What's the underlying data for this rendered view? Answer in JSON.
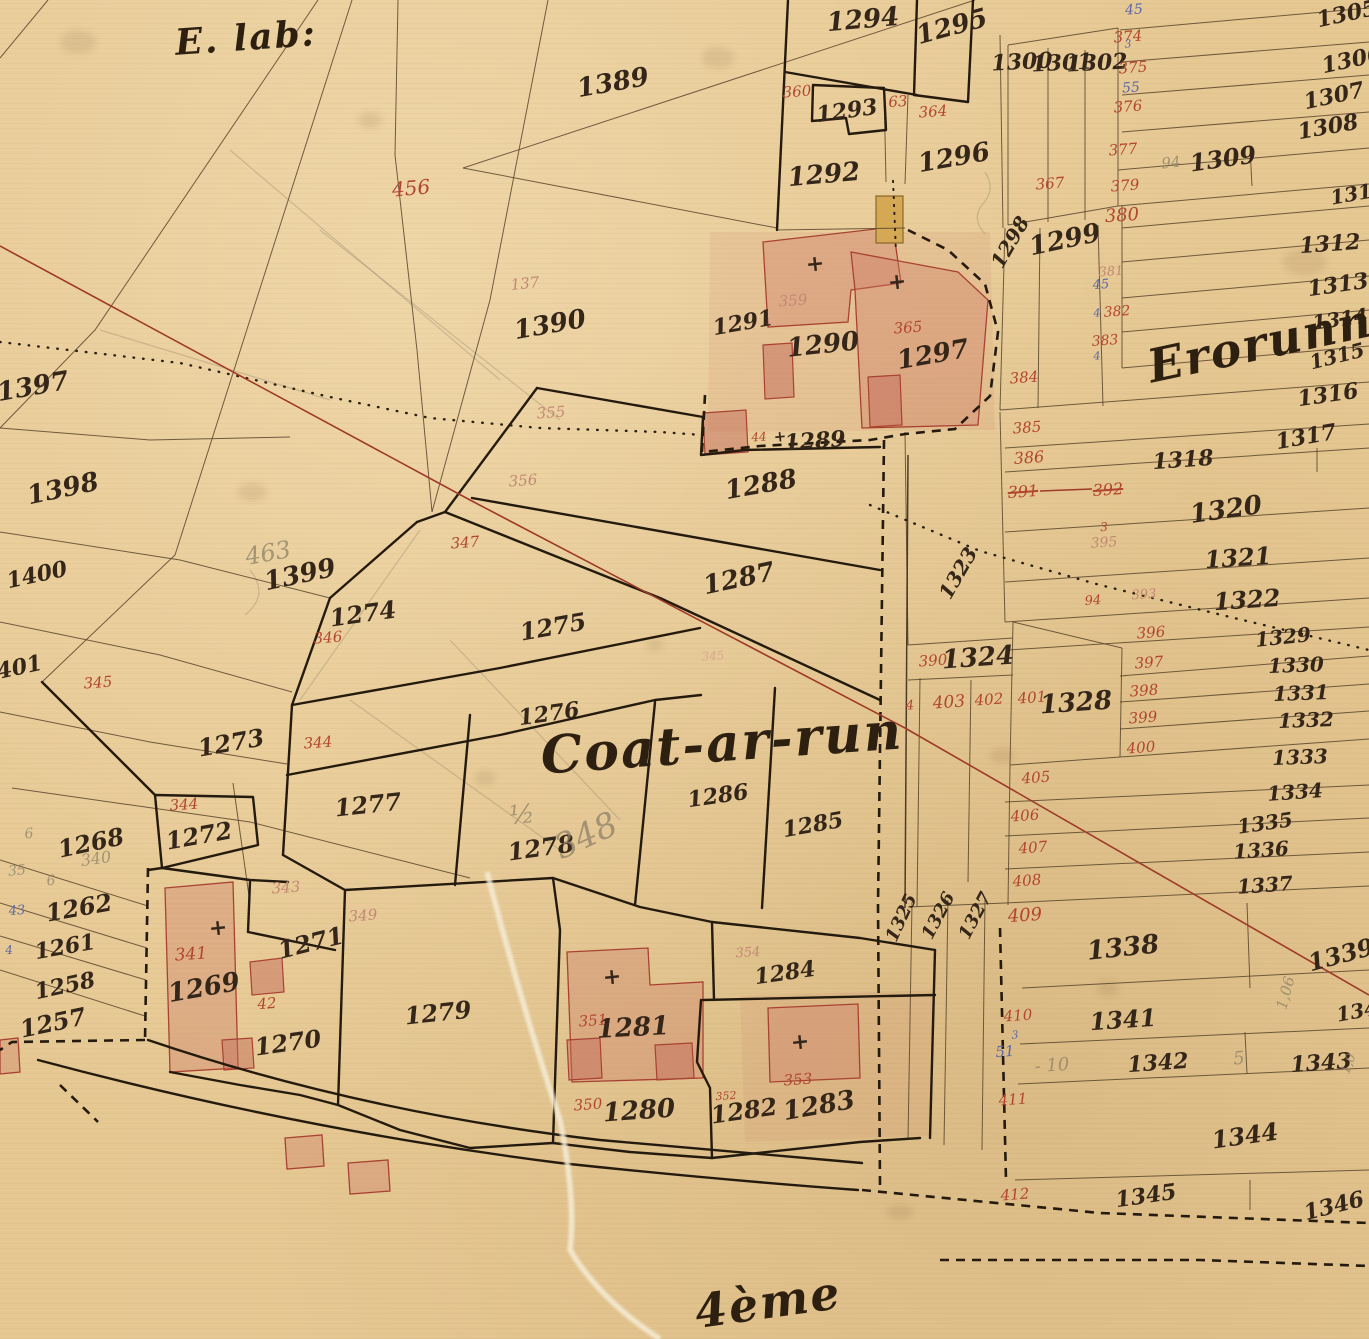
{
  "map_title": "Coat-ar-run",
  "corner_note": "E. lab:",
  "district_note": "Erorunnie",
  "bottom_note": "4ème",
  "colors": {
    "paper": "#e6c893",
    "ink": "#35261a",
    "red": "#b2452f",
    "blue": "#5b68a8",
    "pencil": "#8d8168",
    "building": "#cd7d69",
    "survey_line": "#9e3a28"
  },
  "labels": [
    {
      "t": "1294",
      "x": 863,
      "y": 20,
      "s": 26,
      "c": "ink",
      "r": -5
    },
    {
      "t": "1295",
      "x": 952,
      "y": 27,
      "s": 26,
      "c": "ink",
      "r": -15
    },
    {
      "t": "1300",
      "x": 1022,
      "y": 62,
      "s": 22,
      "c": "ink",
      "r": -3
    },
    {
      "t": "1301",
      "x": 1062,
      "y": 63,
      "s": 22,
      "c": "ink",
      "r": -3
    },
    {
      "t": "1302",
      "x": 1097,
      "y": 63,
      "s": 22,
      "c": "ink",
      "r": -3
    },
    {
      "t": "1293",
      "x": 847,
      "y": 111,
      "s": 22,
      "c": "ink",
      "r": -8
    },
    {
      "t": "1292",
      "x": 824,
      "y": 175,
      "s": 26,
      "c": "ink",
      "r": -5
    },
    {
      "t": "1296",
      "x": 954,
      "y": 158,
      "s": 26,
      "c": "ink",
      "r": -10
    },
    {
      "t": "1305",
      "x": 1347,
      "y": 14,
      "s": 22,
      "c": "ink",
      "r": -12
    },
    {
      "t": "1306",
      "x": 1352,
      "y": 60,
      "s": 22,
      "c": "ink",
      "r": -12
    },
    {
      "t": "1307",
      "x": 1334,
      "y": 96,
      "s": 22,
      "c": "ink",
      "r": -12
    },
    {
      "t": "1308",
      "x": 1328,
      "y": 127,
      "s": 22,
      "c": "ink",
      "r": -10
    },
    {
      "t": "1309",
      "x": 1223,
      "y": 159,
      "s": 24,
      "c": "ink",
      "r": -8
    },
    {
      "t": "1311",
      "x": 1358,
      "y": 193,
      "s": 20,
      "c": "ink",
      "r": -10
    },
    {
      "t": "1312",
      "x": 1330,
      "y": 244,
      "s": 22,
      "c": "ink",
      "r": -4
    },
    {
      "t": "1313",
      "x": 1338,
      "y": 285,
      "s": 22,
      "c": "ink",
      "r": -8
    },
    {
      "t": "1314",
      "x": 1340,
      "y": 319,
      "s": 20,
      "c": "ink",
      "r": -8
    },
    {
      "t": "1315",
      "x": 1337,
      "y": 356,
      "s": 20,
      "c": "ink",
      "r": -14
    },
    {
      "t": "1298",
      "x": 1010,
      "y": 242,
      "s": 20,
      "c": "ink",
      "r": -60
    },
    {
      "t": "1299",
      "x": 1065,
      "y": 240,
      "s": 26,
      "c": "ink",
      "r": -12
    },
    {
      "t": "1291",
      "x": 743,
      "y": 323,
      "s": 22,
      "c": "ink",
      "r": -10
    },
    {
      "t": "1290",
      "x": 823,
      "y": 345,
      "s": 26,
      "c": "ink",
      "r": -6
    },
    {
      "t": "1297",
      "x": 933,
      "y": 355,
      "s": 26,
      "c": "ink",
      "r": -10
    },
    {
      "t": "+",
      "x": 780,
      "y": 437,
      "s": 15,
      "c": "ink",
      "r": 0
    },
    {
      "t": "1289",
      "x": 815,
      "y": 441,
      "s": 22,
      "c": "ink",
      "r": -4
    },
    {
      "t": "1288",
      "x": 761,
      "y": 485,
      "s": 26,
      "c": "ink",
      "r": -10
    },
    {
      "t": "1287",
      "x": 739,
      "y": 579,
      "s": 26,
      "c": "ink",
      "r": -12
    },
    {
      "t": "1316",
      "x": 1328,
      "y": 395,
      "s": 22,
      "c": "ink",
      "r": -8
    },
    {
      "t": "1317",
      "x": 1306,
      "y": 437,
      "s": 22,
      "c": "ink",
      "r": -10
    },
    {
      "t": "1318",
      "x": 1183,
      "y": 460,
      "s": 22,
      "c": "ink",
      "r": -4
    },
    {
      "t": "1320",
      "x": 1226,
      "y": 510,
      "s": 26,
      "c": "ink",
      "r": -8
    },
    {
      "t": "1321",
      "x": 1238,
      "y": 558,
      "s": 24,
      "c": "ink",
      "r": -4
    },
    {
      "t": "1322",
      "x": 1247,
      "y": 600,
      "s": 24,
      "c": "ink",
      "r": -4
    },
    {
      "t": "1389",
      "x": 613,
      "y": 83,
      "s": 26,
      "c": "ink",
      "r": -10
    },
    {
      "t": "1390",
      "x": 550,
      "y": 325,
      "s": 26,
      "c": "ink",
      "r": -10
    },
    {
      "t": "1397",
      "x": 33,
      "y": 387,
      "s": 26,
      "c": "ink",
      "r": -10
    },
    {
      "t": "1398",
      "x": 63,
      "y": 489,
      "s": 26,
      "c": "ink",
      "r": -12
    },
    {
      "t": "1400",
      "x": 37,
      "y": 575,
      "s": 22,
      "c": "ink",
      "r": -12
    },
    {
      "t": "1401",
      "x": 12,
      "y": 669,
      "s": 22,
      "c": "ink",
      "r": -12
    },
    {
      "t": "1399",
      "x": 300,
      "y": 575,
      "s": 26,
      "c": "ink",
      "r": -12
    },
    {
      "t": "1274",
      "x": 363,
      "y": 614,
      "s": 24,
      "c": "ink",
      "r": -8
    },
    {
      "t": "1273",
      "x": 231,
      "y": 743,
      "s": 24,
      "c": "ink",
      "r": -10
    },
    {
      "t": "1272",
      "x": 199,
      "y": 836,
      "s": 24,
      "c": "ink",
      "r": -10
    },
    {
      "t": "1275",
      "x": 553,
      "y": 627,
      "s": 24,
      "c": "ink",
      "r": -10
    },
    {
      "t": "1276",
      "x": 549,
      "y": 714,
      "s": 22,
      "c": "ink",
      "r": -8
    },
    {
      "t": "1277",
      "x": 368,
      "y": 805,
      "s": 24,
      "c": "ink",
      "r": -6
    },
    {
      "t": "1278",
      "x": 541,
      "y": 848,
      "s": 24,
      "c": "ink",
      "r": -8
    },
    {
      "t": "1286",
      "x": 718,
      "y": 796,
      "s": 22,
      "c": "ink",
      "r": -8
    },
    {
      "t": "1285",
      "x": 813,
      "y": 825,
      "s": 22,
      "c": "ink",
      "r": -10
    },
    {
      "t": "1268",
      "x": 91,
      "y": 843,
      "s": 24,
      "c": "ink",
      "r": -12
    },
    {
      "t": "1262",
      "x": 79,
      "y": 908,
      "s": 24,
      "c": "ink",
      "r": -10
    },
    {
      "t": "1261",
      "x": 65,
      "y": 947,
      "s": 22,
      "c": "ink",
      "r": -10
    },
    {
      "t": "1258",
      "x": 65,
      "y": 986,
      "s": 22,
      "c": "ink",
      "r": -12
    },
    {
      "t": "1257",
      "x": 53,
      "y": 1023,
      "s": 24,
      "c": "ink",
      "r": -12
    },
    {
      "t": "1269",
      "x": 204,
      "y": 988,
      "s": 26,
      "c": "ink",
      "r": -10
    },
    {
      "t": "1270",
      "x": 288,
      "y": 1043,
      "s": 24,
      "c": "ink",
      "r": -8
    },
    {
      "t": "1271",
      "x": 311,
      "y": 943,
      "s": 24,
      "c": "ink",
      "r": -14
    },
    {
      "t": "1279",
      "x": 438,
      "y": 1013,
      "s": 24,
      "c": "ink",
      "r": -6
    },
    {
      "t": "1281",
      "x": 633,
      "y": 1028,
      "s": 26,
      "c": "ink",
      "r": -3
    },
    {
      "t": "1280",
      "x": 639,
      "y": 1111,
      "s": 26,
      "c": "ink",
      "r": -4
    },
    {
      "t": "1282",
      "x": 744,
      "y": 1111,
      "s": 24,
      "c": "ink",
      "r": -8
    },
    {
      "t": "1283",
      "x": 819,
      "y": 1106,
      "s": 26,
      "c": "ink",
      "r": -10
    },
    {
      "t": "1284",
      "x": 785,
      "y": 973,
      "s": 22,
      "c": "ink",
      "r": -8
    },
    {
      "t": "1323",
      "x": 958,
      "y": 573,
      "s": 20,
      "c": "ink",
      "r": -60
    },
    {
      "t": "1324",
      "x": 978,
      "y": 658,
      "s": 26,
      "c": "ink",
      "r": -4
    },
    {
      "t": "1328",
      "x": 1076,
      "y": 703,
      "s": 26,
      "c": "ink",
      "r": -4
    },
    {
      "t": "1329",
      "x": 1283,
      "y": 637,
      "s": 20,
      "c": "ink",
      "r": -6
    },
    {
      "t": "1330",
      "x": 1296,
      "y": 665,
      "s": 20,
      "c": "ink",
      "r": -2
    },
    {
      "t": "1331",
      "x": 1301,
      "y": 693,
      "s": 20,
      "c": "ink",
      "r": -2
    },
    {
      "t": "1332",
      "x": 1306,
      "y": 720,
      "s": 20,
      "c": "ink",
      "r": -2
    },
    {
      "t": "1333",
      "x": 1300,
      "y": 757,
      "s": 20,
      "c": "ink",
      "r": -2
    },
    {
      "t": "1334",
      "x": 1295,
      "y": 792,
      "s": 20,
      "c": "ink",
      "r": -4
    },
    {
      "t": "1335",
      "x": 1265,
      "y": 823,
      "s": 20,
      "c": "ink",
      "r": -8
    },
    {
      "t": "1336",
      "x": 1261,
      "y": 850,
      "s": 20,
      "c": "ink",
      "r": -4
    },
    {
      "t": "1337",
      "x": 1265,
      "y": 885,
      "s": 20,
      "c": "ink",
      "r": -4
    },
    {
      "t": "1338",
      "x": 1123,
      "y": 948,
      "s": 26,
      "c": "ink",
      "r": -6
    },
    {
      "t": "1339",
      "x": 1341,
      "y": 955,
      "s": 24,
      "c": "ink",
      "r": -15
    },
    {
      "t": "1325",
      "x": 902,
      "y": 918,
      "s": 18,
      "c": "ink",
      "r": -65
    },
    {
      "t": "1326",
      "x": 939,
      "y": 916,
      "s": 18,
      "c": "ink",
      "r": -62
    },
    {
      "t": "1327",
      "x": 976,
      "y": 916,
      "s": 18,
      "c": "ink",
      "r": -62
    },
    {
      "t": "1341",
      "x": 1123,
      "y": 1020,
      "s": 24,
      "c": "ink",
      "r": -4
    },
    {
      "t": "1342",
      "x": 1158,
      "y": 1063,
      "s": 22,
      "c": "ink",
      "r": -4
    },
    {
      "t": "1343",
      "x": 1321,
      "y": 1063,
      "s": 22,
      "c": "ink",
      "r": -4
    },
    {
      "t": "1340",
      "x": 1364,
      "y": 1010,
      "s": 20,
      "c": "ink",
      "r": -10
    },
    {
      "t": "1344",
      "x": 1245,
      "y": 1136,
      "s": 24,
      "c": "ink",
      "r": -8
    },
    {
      "t": "1345",
      "x": 1146,
      "y": 1196,
      "s": 22,
      "c": "ink",
      "r": -8
    },
    {
      "t": "1346",
      "x": 1334,
      "y": 1206,
      "s": 22,
      "c": "ink",
      "r": -14
    },
    {
      "t": "+",
      "x": 815,
      "y": 264,
      "s": 22,
      "c": "ink",
      "r": 0
    },
    {
      "t": "+",
      "x": 897,
      "y": 282,
      "s": 22,
      "c": "ink",
      "r": 0
    },
    {
      "t": "+",
      "x": 218,
      "y": 928,
      "s": 22,
      "c": "ink",
      "r": 0
    },
    {
      "t": "+",
      "x": 612,
      "y": 977,
      "s": 22,
      "c": "ink",
      "r": 0
    },
    {
      "t": "+",
      "x": 800,
      "y": 1042,
      "s": 22,
      "c": "ink",
      "r": 0
    },
    {
      "t": "456",
      "x": 411,
      "y": 188,
      "s": 20,
      "c": "red",
      "r": -5
    },
    {
      "t": "360",
      "x": 797,
      "y": 92,
      "s": 15,
      "c": "red",
      "r": -4
    },
    {
      "t": "63",
      "x": 898,
      "y": 102,
      "s": 15,
      "c": "red",
      "r": -4
    },
    {
      "t": "364",
      "x": 933,
      "y": 112,
      "s": 15,
      "c": "red",
      "r": -4
    },
    {
      "t": "367",
      "x": 1050,
      "y": 184,
      "s": 15,
      "c": "red",
      "r": -4
    },
    {
      "t": "374",
      "x": 1128,
      "y": 37,
      "s": 15,
      "c": "red",
      "r": -4
    },
    {
      "t": "375",
      "x": 1133,
      "y": 68,
      "s": 15,
      "c": "red",
      "r": -4
    },
    {
      "t": "376",
      "x": 1128,
      "y": 107,
      "s": 15,
      "c": "red",
      "r": -4
    },
    {
      "t": "377",
      "x": 1123,
      "y": 150,
      "s": 15,
      "c": "red",
      "r": -4
    },
    {
      "t": "379",
      "x": 1125,
      "y": 186,
      "s": 15,
      "c": "red",
      "r": -4
    },
    {
      "t": "380",
      "x": 1122,
      "y": 216,
      "s": 18,
      "c": "red",
      "r": -4
    },
    {
      "t": "381",
      "x": 1111,
      "y": 272,
      "s": 13,
      "c": "fred",
      "r": -4
    },
    {
      "t": "382",
      "x": 1117,
      "y": 312,
      "s": 14,
      "c": "red",
      "r": -4
    },
    {
      "t": "383",
      "x": 1105,
      "y": 341,
      "s": 14,
      "c": "red",
      "r": -4
    },
    {
      "t": "384",
      "x": 1024,
      "y": 378,
      "s": 15,
      "c": "red",
      "r": -4
    },
    {
      "t": "385",
      "x": 1027,
      "y": 428,
      "s": 15,
      "c": "red",
      "r": -4
    },
    {
      "t": "386",
      "x": 1029,
      "y": 458,
      "s": 16,
      "c": "red",
      "r": -4
    },
    {
      "t": "391",
      "x": 1023,
      "y": 492,
      "s": 16,
      "c": "red",
      "r": -4,
      "st": 1
    },
    {
      "t": "392",
      "x": 1108,
      "y": 490,
      "s": 16,
      "c": "red",
      "r": -4,
      "st": 1
    },
    {
      "t": "3",
      "x": 1104,
      "y": 527,
      "s": 12,
      "c": "red",
      "r": -4
    },
    {
      "t": "395",
      "x": 1104,
      "y": 543,
      "s": 14,
      "c": "fred",
      "r": -4
    },
    {
      "t": "94",
      "x": 1093,
      "y": 601,
      "s": 13,
      "c": "red",
      "r": -4
    },
    {
      "t": "393",
      "x": 1144,
      "y": 595,
      "s": 13,
      "c": "fred",
      "r": -4
    },
    {
      "t": "396",
      "x": 1151,
      "y": 633,
      "s": 15,
      "c": "red",
      "r": -4
    },
    {
      "t": "397",
      "x": 1149,
      "y": 663,
      "s": 15,
      "c": "red",
      "r": -4
    },
    {
      "t": "398",
      "x": 1144,
      "y": 691,
      "s": 15,
      "c": "red",
      "r": -4
    },
    {
      "t": "399",
      "x": 1143,
      "y": 718,
      "s": 15,
      "c": "red",
      "r": -4
    },
    {
      "t": "400",
      "x": 1141,
      "y": 748,
      "s": 15,
      "c": "red",
      "r": -4
    },
    {
      "t": "390",
      "x": 933,
      "y": 661,
      "s": 15,
      "c": "red",
      "r": -4
    },
    {
      "t": "403",
      "x": 949,
      "y": 703,
      "s": 17,
      "c": "red",
      "r": -4
    },
    {
      "t": "402",
      "x": 989,
      "y": 700,
      "s": 15,
      "c": "red",
      "r": -4
    },
    {
      "t": "401",
      "x": 1032,
      "y": 698,
      "s": 15,
      "c": "red",
      "r": -4
    },
    {
      "t": "4",
      "x": 910,
      "y": 706,
      "s": 13,
      "c": "red",
      "r": -4
    },
    {
      "t": "405",
      "x": 1036,
      "y": 778,
      "s": 15,
      "c": "red",
      "r": -4
    },
    {
      "t": "406",
      "x": 1025,
      "y": 816,
      "s": 15,
      "c": "red",
      "r": -4
    },
    {
      "t": "407",
      "x": 1033,
      "y": 848,
      "s": 15,
      "c": "red",
      "r": -4
    },
    {
      "t": "408",
      "x": 1027,
      "y": 881,
      "s": 15,
      "c": "red",
      "r": -4
    },
    {
      "t": "409",
      "x": 1025,
      "y": 916,
      "s": 18,
      "c": "red",
      "r": -4
    },
    {
      "t": "410",
      "x": 1018,
      "y": 1016,
      "s": 15,
      "c": "red",
      "r": -4
    },
    {
      "t": "411",
      "x": 1013,
      "y": 1100,
      "s": 15,
      "c": "red",
      "r": -4
    },
    {
      "t": "412",
      "x": 1015,
      "y": 1195,
      "s": 15,
      "c": "red",
      "r": -4
    },
    {
      "t": "359",
      "x": 793,
      "y": 301,
      "s": 15,
      "c": "fred",
      "r": -4
    },
    {
      "t": "365",
      "x": 908,
      "y": 328,
      "s": 15,
      "c": "red",
      "r": -4
    },
    {
      "t": "44",
      "x": 759,
      "y": 437,
      "s": 12,
      "c": "red",
      "r": -4
    },
    {
      "t": "355",
      "x": 551,
      "y": 413,
      "s": 15,
      "c": "fred",
      "r": -4
    },
    {
      "t": "356",
      "x": 523,
      "y": 481,
      "s": 15,
      "c": "fred",
      "r": -4
    },
    {
      "t": "347",
      "x": 465,
      "y": 543,
      "s": 15,
      "c": "red",
      "r": -4
    },
    {
      "t": "346",
      "x": 328,
      "y": 638,
      "s": 15,
      "c": "red",
      "r": -4
    },
    {
      "t": "345",
      "x": 98,
      "y": 683,
      "s": 15,
      "c": "red",
      "r": -4
    },
    {
      "t": "344",
      "x": 318,
      "y": 743,
      "s": 15,
      "c": "red",
      "r": -4
    },
    {
      "t": "344",
      "x": 184,
      "y": 805,
      "s": 15,
      "c": "red",
      "r": -4
    },
    {
      "t": "343",
      "x": 286,
      "y": 888,
      "s": 15,
      "c": "fred",
      "r": -4
    },
    {
      "t": "349",
      "x": 363,
      "y": 916,
      "s": 15,
      "c": "fred",
      "r": -4
    },
    {
      "t": "341",
      "x": 191,
      "y": 955,
      "s": 17,
      "c": "red",
      "r": -4
    },
    {
      "t": "42",
      "x": 267,
      "y": 1004,
      "s": 15,
      "c": "red",
      "r": -4
    },
    {
      "t": "350",
      "x": 588,
      "y": 1105,
      "s": 15,
      "c": "red",
      "r": -4
    },
    {
      "t": "351",
      "x": 593,
      "y": 1021,
      "s": 15,
      "c": "red",
      "r": -4
    },
    {
      "t": "352",
      "x": 726,
      "y": 1096,
      "s": 11,
      "c": "red",
      "r": -4
    },
    {
      "t": "353",
      "x": 798,
      "y": 1080,
      "s": 15,
      "c": "red",
      "r": -4
    },
    {
      "t": "354",
      "x": 748,
      "y": 953,
      "s": 13,
      "c": "fred",
      "r": -4
    },
    {
      "t": "345",
      "x": 713,
      "y": 656,
      "s": 12,
      "c": "fpink",
      "r": -4
    },
    {
      "t": "45",
      "x": 1134,
      "y": 10,
      "s": 14,
      "c": "blue",
      "r": -4
    },
    {
      "t": "3",
      "x": 1128,
      "y": 44,
      "s": 11,
      "c": "blue",
      "r": -4
    },
    {
      "t": "55",
      "x": 1131,
      "y": 88,
      "s": 14,
      "c": "blue",
      "r": -4
    },
    {
      "t": "45",
      "x": 1101,
      "y": 285,
      "s": 13,
      "c": "blue",
      "r": -4
    },
    {
      "t": "4",
      "x": 1097,
      "y": 313,
      "s": 11,
      "c": "blue",
      "r": -4
    },
    {
      "t": "4",
      "x": 1097,
      "y": 356,
      "s": 11,
      "c": "blue",
      "r": -4
    },
    {
      "t": "43",
      "x": 17,
      "y": 911,
      "s": 13,
      "c": "blue",
      "r": -4
    },
    {
      "t": "4",
      "x": 9,
      "y": 950,
      "s": 12,
      "c": "blue",
      "r": -4
    },
    {
      "t": "3",
      "x": 1015,
      "y": 1035,
      "s": 11,
      "c": "blue",
      "r": -4
    },
    {
      "t": "51",
      "x": 1005,
      "y": 1052,
      "s": 15,
      "c": "blue",
      "r": -4
    },
    {
      "t": "463",
      "x": 268,
      "y": 553,
      "s": 24,
      "c": "pencil",
      "r": -10
    },
    {
      "t": "340",
      "x": 96,
      "y": 859,
      "s": 16,
      "c": "pencil",
      "r": -8
    },
    {
      "t": "35",
      "x": 17,
      "y": 871,
      "s": 14,
      "c": "pencil",
      "r": -6
    },
    {
      "t": "6",
      "x": 29,
      "y": 834,
      "s": 14,
      "c": "pencil",
      "r": 0
    },
    {
      "t": "6",
      "x": 51,
      "y": 881,
      "s": 14,
      "c": "pencil",
      "r": 0
    },
    {
      "t": "348",
      "x": 586,
      "y": 836,
      "s": 34,
      "c": "pencil",
      "r": -25
    },
    {
      "t": "½",
      "x": 522,
      "y": 815,
      "s": 26,
      "c": "pencil",
      "r": -5
    },
    {
      "t": "- 10",
      "x": 1052,
      "y": 1066,
      "s": 18,
      "c": "pencil",
      "r": -4
    },
    {
      "t": "5",
      "x": 1239,
      "y": 1059,
      "s": 18,
      "c": "pencil",
      "r": -6
    },
    {
      "t": "1,06",
      "x": 1286,
      "y": 993,
      "s": 15,
      "c": "pencil",
      "r": -75
    },
    {
      "t": "1,0",
      "x": 1349,
      "y": 1064,
      "s": 13,
      "c": "pencil",
      "r": -70
    },
    {
      "t": "94",
      "x": 1171,
      "y": 163,
      "s": 15,
      "c": "pencil",
      "r": -6
    },
    {
      "t": "137",
      "x": 525,
      "y": 284,
      "s": 15,
      "c": "fred",
      "r": -6
    }
  ]
}
